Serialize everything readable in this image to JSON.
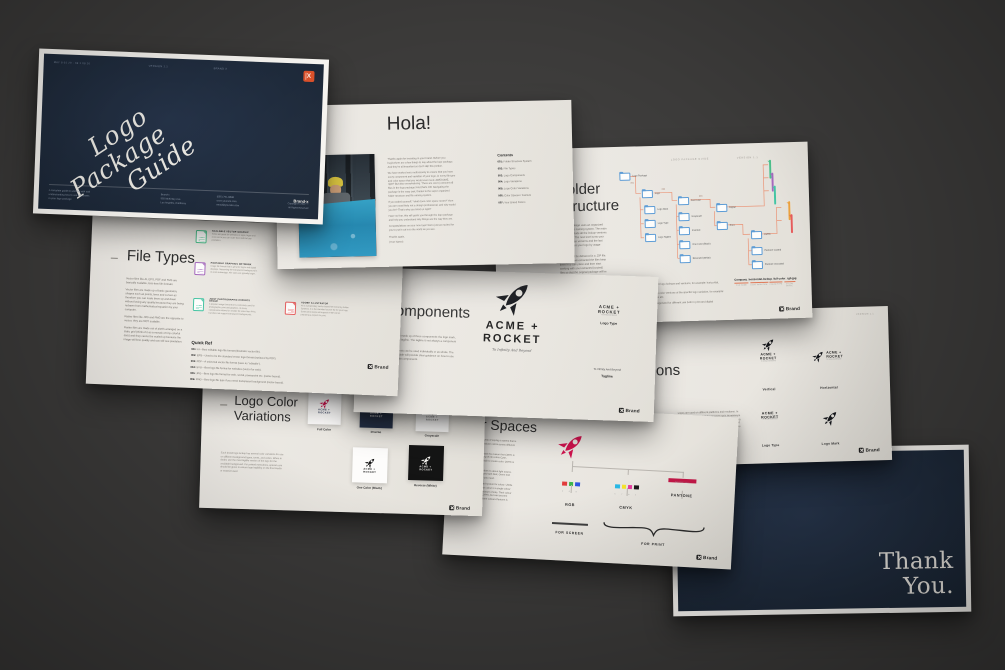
{
  "colors": {
    "backdrop": "#3b3a39",
    "paper": "#e9e6e0",
    "navy": "#1f2b3c",
    "accent_orange": "#d9502a",
    "rocket_red": "#d0104c",
    "connector_salmon": "#ea9477",
    "folder_blue": "#5b9bd5",
    "rgb_swatches": [
      "#e23c3c",
      "#3cb54a",
      "#2f54e0"
    ],
    "cmyk_swatches": [
      "#29b8e5",
      "#f4e32c",
      "#e43a9d",
      "#1a1a1a"
    ],
    "pantone_bar": "#c21747"
  },
  "brand": {
    "footer_logo": "Brand",
    "mark_letter": "X",
    "acme_top": "ACME +",
    "acme_bottom": "ROCKET",
    "acme_stacked": "ACME +\nROCKET",
    "tagline": "To Infinity And Beyond"
  },
  "title_slide": {
    "meta_date": "MAY 8 01 20 · 08 1 08 20",
    "meta_version": "VERSION 1.1",
    "meta_brand": "BRAND X",
    "title_line1": "Logo",
    "title_line2": "Package",
    "title_line3": "Guide",
    "about_lines": [
      "A complete guide to working with and",
      "understanding how to use the assets",
      "in your logo package"
    ],
    "address_lines": [
      "Brand-x",
      "555 McKinley Ave",
      "Los Angeles, California"
    ],
    "contact_lines": [
      "(555) 751-9838",
      "www.yoursite.com",
      "email@yoursite.com"
    ],
    "copy_name": "Brand-x",
    "copy_lines": [
      "Copyright © 2022 ™",
      "All Rights Reserved"
    ]
  },
  "hola": {
    "title": "Hola!",
    "paragraphs": [
      "Thanks again for investing in your brand. Before you begin,there are a few things to say about the logo package. And they're all important so don't skip this portion.",
      "We have worked very meticulously to ensure that you have every component and variation of your logo, in every file type and color space that you would ever need. AWESOME, right? But also overwhelming. There are over (x amount of) files in the logo package! And that's OK! Navigating the package is the easy part, thanks to the super organized folder structure and file naming system.",
      "If you asked yourself, \"what does color space mean?\" then you are most likely not a design professional, and why would you be? That's why you hired us right?",
      "Have no fear, this will guide you through the logo package and help you understand why things are the way they are.",
      "Congratulations on your new logo! We're just as excited for you to put it out in to the world as you are.",
      "Thanks again,",
      "(Your Name)"
    ],
    "contents_title": "Contents",
    "contents": [
      {
        "num": "001:",
        "label": "Folder Structure System"
      },
      {
        "num": "002:",
        "label": "File Types"
      },
      {
        "num": "003:",
        "label": "Logo Components"
      },
      {
        "num": "004:",
        "label": "Logo Variations"
      },
      {
        "num": "005:",
        "label": "Logo Color Variations"
      },
      {
        "num": "006:",
        "label": "Color Spaces / Gamuts"
      },
      {
        "num": "007:",
        "label": "Your Brand Colors"
      }
    ]
  },
  "folder_structure": {
    "meta_left": "LOGO PACKAGE GUIDE",
    "meta_right": "VERSION 1.1",
    "title_line1": "Folder",
    "title_line2": "Structure",
    "intro": "The logo package uses an organized folder and file naming system. The main folder will include all the lockup versions of your logo. The next level sorts your files into colour versions and the last section divides your logo by usage purposes.",
    "intro2": "Your files will be delivered in a .ZIP file. Once you have extracted the files keep them in a safe place and then start working with your extracted (copied) files so that the original package will be intact in the .ZIP file.",
    "nodes": [
      "Logo Package",
      "Logo",
      "Logo Mark",
      "Logo Type",
      "Logo Tagline",
      "Full Color",
      "Grayscale",
      "Inverted",
      "One Color (Black)",
      "Reversed (White)",
      "Digital",
      "Print",
      "CMYK",
      "Pantone Coated",
      "Pantone Uncoated"
    ],
    "connector_labels": [
      "001",
      "002",
      "003"
    ],
    "quick_ref_title": "Quick Ref",
    "quick_ref": [
      {
        "num": "001:",
        "text": "Logo Variations - different logo lockups and versions, for example: horizontal, vertical, brandmark etc."
      },
      {
        "num": "002:",
        "text": "Color Versions - multiple color versions of the specific logo variation, for example: full color, inverse, black, white etc."
      },
      {
        "num": "003:",
        "text": "Color Spaces - files categorized for different use both in print and digital (CMYK,RGB & PANTONE)"
      }
    ],
    "filename_example": "Company_horizontal-lockup_full-color_rgb.jpg",
    "filename_labels": [
      "FILE NAME",
      "LOGO VARIATION",
      "COLOR TYPE",
      "COLOR SPACE"
    ]
  },
  "file_types": {
    "title": "File Types",
    "paragraphs": [
      "Vector files like AI, EPS, PDF and SVG are basically scalable, loss-less file formats.",
      "Vector files are made up of basic geometric shapes such as points, lines and curves as therefore you can scale them up and down without losing any quality because they are being redrawn from mathematical equation by your computer.",
      "Raster files like JPG and PNG are the opposite to vector, they are NOT scalable.",
      "Raster files are made out of pixels arranged on a static grid (think of it as a mosaic of tiny colorful dots) and they cannot be scaled up because the image will lose quality and you will see pixelation."
    ],
    "items": [
      {
        "abbr": "SVG",
        "title": "SCALABLE VECTOR GRAPHIC",
        "desc": "SVGs are great for websites or apps, logos and icons since you can scale them without any pixelation.",
        "color": "#4cbf8b"
      },
      {
        "abbr": "PNG",
        "title": "PORTABLE GRAPHICS NETWORK",
        "desc": "Image file format that is great for logos and digital displays. Supporting the transparent background is its main advantage. File sizes are typically larger.",
        "color": "#a569bd"
      },
      {
        "abbr": "JPG",
        "title": "JOINT PHOTOGRAPHIC EXPERTS GROUP",
        "desc": "A popular image format that is commonly used for photographs, print and graphics. Its lossy compression allows for smaller file sizes than PNG, but does not support transparent backgrounds.",
        "color": "#45c4a3"
      },
      {
        "abbr": "AI",
        "title": "ADOBE ILLUSTRATOR",
        "desc": "AI is a proprietary vector based file format by Adobe Systems. It is the standard source file for your logo. Some print shops will request AI files when preparing a project for print.",
        "color": "#e55c5c"
      }
    ],
    "quick_ref_title": "Quick Ref",
    "quick_ref": [
      {
        "num": "001:",
        "text": "AI—Best editable logo file format (Illustrator vector file)."
      },
      {
        "num": "002:",
        "text": "EPS—Used to be the standard vector logo format (replaced by PDF)."
      },
      {
        "num": "003:",
        "text": "PDF—A universal vector file format (save as \"editable\")."
      },
      {
        "num": "004:",
        "text": "SVG—Best logo file format for websites (vector for web)."
      },
      {
        "num": "005:",
        "text": "JPG—Best logo file format for web, social, powerpoint etc. (raster-based)."
      },
      {
        "num": "006:",
        "text": "PNG—Best logo file type if you need transparent background (raster-based)."
      }
    ]
  },
  "components": {
    "title": "Components",
    "paragraphs": [
      "A logo can be made up of three components: the logo mark, logo type and tagline. The tagline is not always a component of the logo.",
      "The components can be used individually or as whole. The brand style guide will provide clear guidance on how to use the logo and its components."
    ],
    "label_logo_type": "Logo Type",
    "label_tagline": "Tagline"
  },
  "variations": {
    "meta_version": "VERSION 1.1",
    "title": "Variations",
    "body": "Logos are used on different platforms and mediums. In regular occasions, one style just won't cut it. At minimum there will always be a vertical lockup, a horizontal lockup, the logo type and the logo mark. Once again: The brand style guide will provide clear guidance on how to use the variations.",
    "labels": [
      "Vertical",
      "Horizontal",
      "Logo Type",
      "Logo Mark"
    ]
  },
  "color_variations": {
    "title_line1": "Logo Color",
    "title_line2": "Variations",
    "body": "Each brand logo lockup has several color variations for use on different background types, tones, and colors. When in doubt, use the most legible version of the logo for the available background. For printed executions, special care should be given to ensure logo legibility on the final media or material used.",
    "labels": [
      "Full Color",
      "Inverse",
      "Grayscale",
      "One Color (Black)",
      "Reverse (White)"
    ]
  },
  "color_spaces": {
    "title": "Color Spaces",
    "paragraphs": [
      "Color space is a fancy way of saying a system that is used to accurately reproduce colors across different mediums.",
      "It is not hard to understand the reason that CMYK is used for print. The mixing of ink colors Cyan, Magenta, Yellow and Black to create color. CMYK is the best file for print.",
      "RGB is digital and therefore it's about light source. The colors are being mixed with Red, Green and Blue to create any color you need.",
      "Pantone is a standardised system for colour. Unlike CMYK, a Pantone or spot colour is a single colour created from a precise mixture of inks. Their colour accuracy is superior to CMYK, but can become costly using more than three colours.Pantone is"
    ],
    "rgb_label": "RGB",
    "cmyk_label": "CMYK",
    "pantone_label": "PANTONE",
    "rgb_letters": "R  G  B",
    "cmyk_letters": "C  Y  M  K",
    "pantone_code": "PANTONE 199 C",
    "for_screen": "FOR SCREEN",
    "for_print": "FOR PRINT"
  },
  "thank_you": {
    "line1": "Thank",
    "line2": "You."
  }
}
